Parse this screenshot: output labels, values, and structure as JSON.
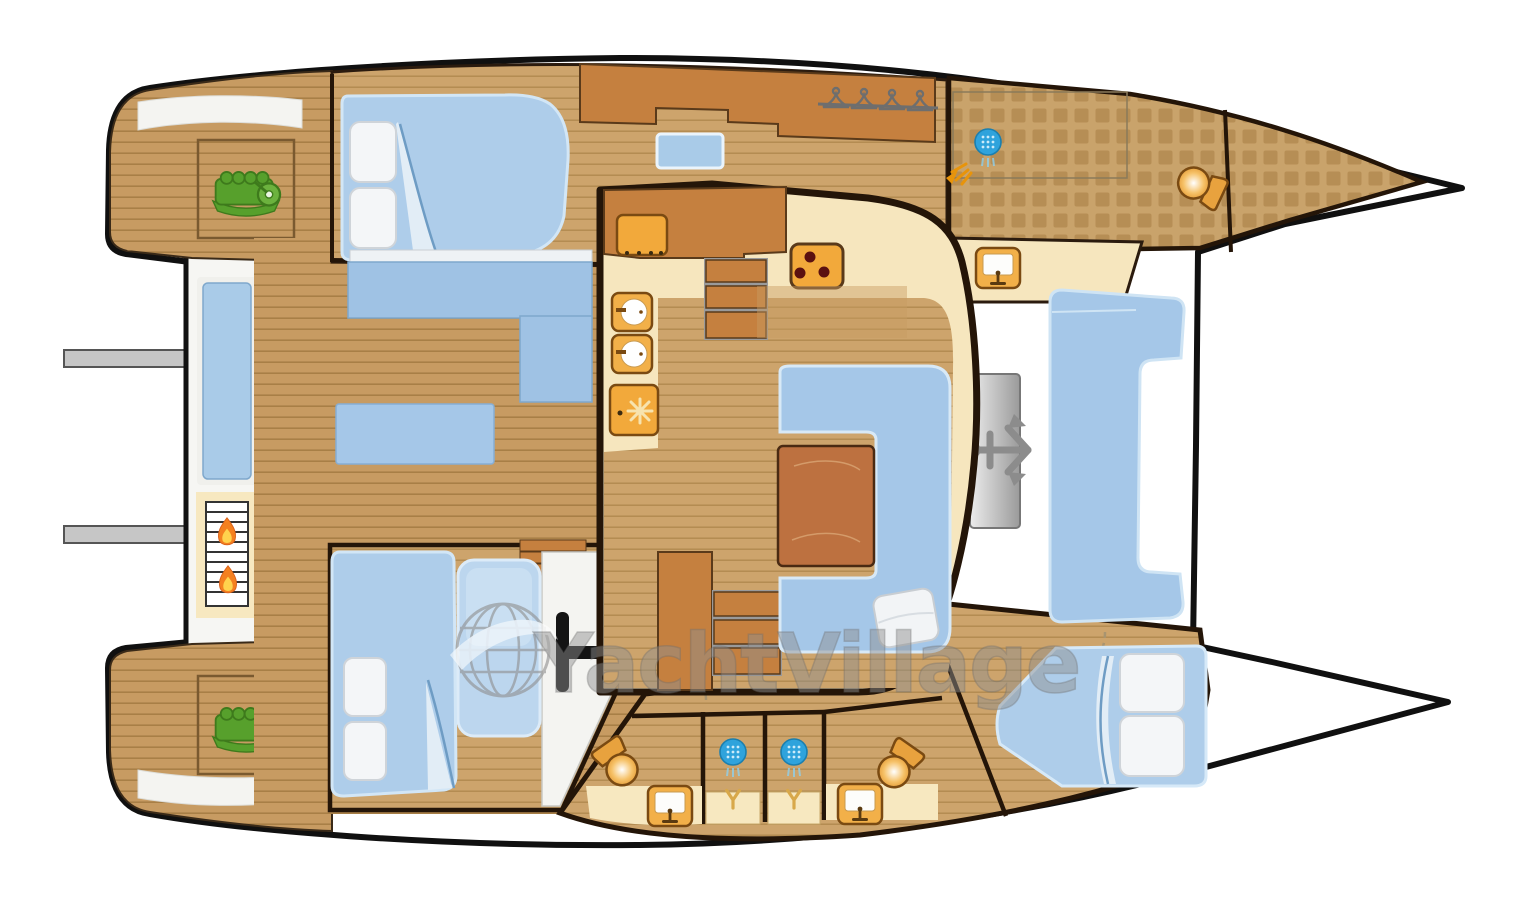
{
  "watermark": {
    "text": "YachtVillage",
    "color": "#8F8F8F"
  },
  "palette": {
    "hull_outline": "#101010",
    "deck_teak": "#C79B62",
    "plank_line": "#A87F46",
    "interior_floor": "#CDA46C",
    "wood_furniture": "#C5803F",
    "counter_cream": "#F6E6BE",
    "appliance_orange": "#F2A93B",
    "cushion_blue": "#A5C7E8",
    "bed_blue": "#AECDEA",
    "window_blue": "#A9CBE8",
    "tile_base": "#C9A36B",
    "tile_square": "#B68E55",
    "engine_green": "#57A02C",
    "flame_orange": "#F4801F",
    "anchor_gray": "#8C8C8C",
    "shower_blue": "#2FA3DC",
    "white_deck": "#FFFFFF"
  },
  "icons": [
    "engine-icon",
    "bbq-grill-icon",
    "flame-icon",
    "anchor-windlass-icon",
    "anchor-icon",
    "shower-head-icon",
    "spray-icon",
    "toilet-icon",
    "sink-icon",
    "stove-icon",
    "oven-icon",
    "fridge-snowflake-icon",
    "clothes-hanger-icon",
    "globe-watermark-icon"
  ]
}
